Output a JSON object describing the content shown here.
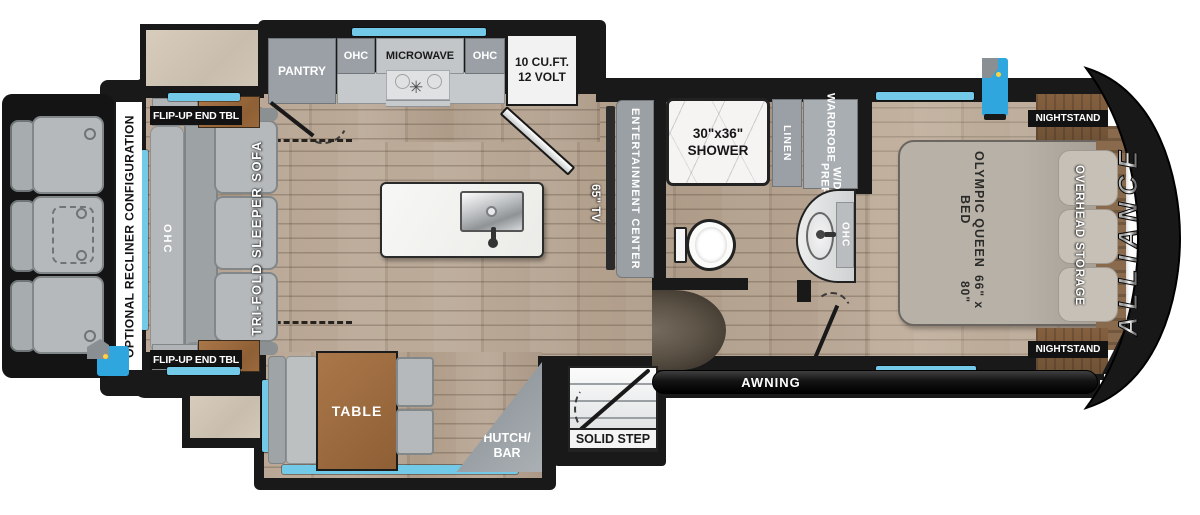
{
  "floorplan": {
    "brand": "ALLIANCE",
    "optional_config": "OPTIONAL RECLINER CONFIGURATION",
    "living": {
      "flip_up_end_tbl_top": "FLIP-UP END TBL",
      "flip_up_end_tbl_bottom": "FLIP-UP END TBL",
      "sofa_ohc": "OHC",
      "sofa": "TRI-FOLD SLEEPER SOFA",
      "tv": "65\" TV",
      "entertainment_center": "ENTERTAINMENT CENTER"
    },
    "kitchen": {
      "pantry": "PANTRY",
      "ohc_left": "OHC",
      "microwave": "MICROWAVE",
      "ohc_right": "OHC",
      "fridge_line1": "10 CU.FT.",
      "fridge_line2": "12 VOLT"
    },
    "bath": {
      "shower_line1": "30\"x36\"",
      "shower_line2": "SHOWER",
      "linen": "LINEN",
      "wardrobe_line1": "WARDROBE",
      "wardrobe_line2": "W/D PREP",
      "vanity_ohc": "OHC"
    },
    "bedroom": {
      "bed_line1": "OLYMPIC QUEEN BED",
      "bed_line2": "66\" x 80\"",
      "overhead_storage": "OVERHEAD STORAGE",
      "nightstand_top": "NIGHTSTAND",
      "nightstand_bottom": "NIGHTSTAND"
    },
    "dinette": {
      "table": "TABLE",
      "hutch_line1": "HUTCH/",
      "hutch_line2": "BAR"
    },
    "exterior": {
      "solid_step": "SOLID STEP",
      "awning": "AWNING"
    },
    "icons": {
      "top_utility": "exterior-hookup-icon",
      "bottom_utility": "exterior-hookup-icon"
    },
    "colors": {
      "window_blue": "#72c9e8",
      "wall_black": "#191919",
      "cabinet_gray": "#9aa0a5",
      "table_wood": "#9a6a3d",
      "floor_wood": "#b3a08d",
      "utility_blue": "#2fa6dd"
    }
  }
}
